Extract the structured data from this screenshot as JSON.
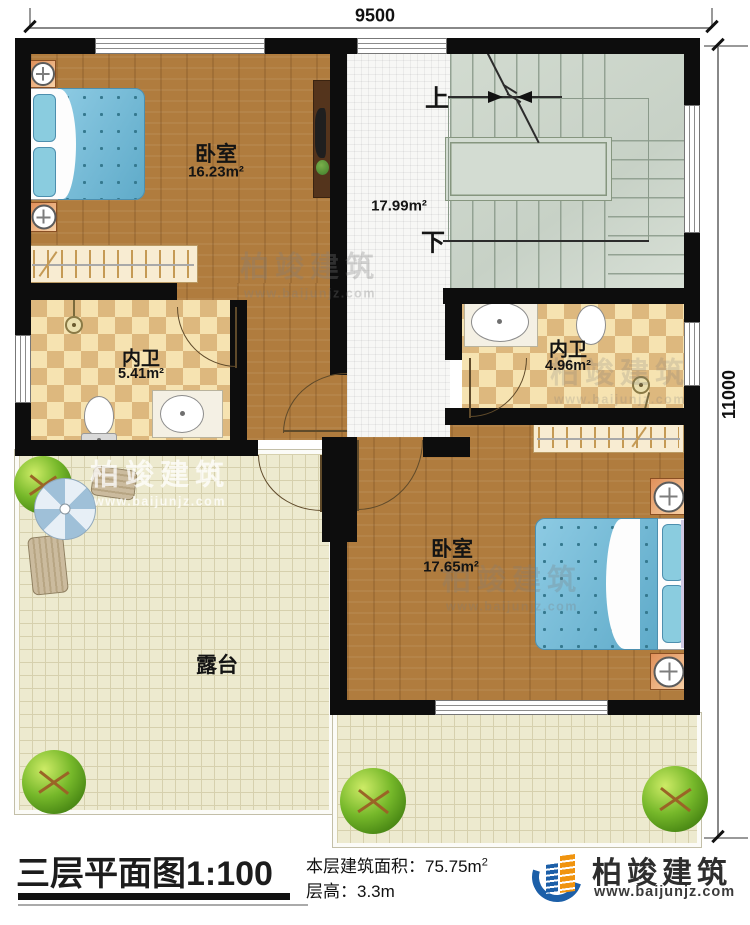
{
  "dimensions": {
    "top": "9500",
    "right": "11000"
  },
  "rooms": {
    "bedroom_top": {
      "name": "卧室",
      "area": "16.23m²"
    },
    "bedroom_bottom": {
      "name": "卧室",
      "area": "17.65m²"
    },
    "bathroom_left": {
      "name": "内卫",
      "area": "5.41m²"
    },
    "bathroom_right": {
      "name": "内卫",
      "area": "4.96m²"
    },
    "stair_hall": {
      "area": "17.99m²",
      "up_label": "上",
      "down_label": "下"
    },
    "terrace": {
      "name": "露台"
    }
  },
  "title_block": {
    "title": "三层平面图1:100",
    "floor_area_label": "本层建筑面积：",
    "floor_area_value": "75.75m",
    "floor_area_sup": "2",
    "floor_height_label": "层高：",
    "floor_height_value": "3.3m"
  },
  "brand": {
    "name": "柏竣建筑",
    "website": "www.baijunjz.com"
  },
  "watermark": {
    "name": "柏竣建筑",
    "website": "www.baijunjz.com"
  },
  "colors": {
    "wall": "#0d0d0d",
    "wood_floor": "#b07c3e",
    "tile_light": "#f6e3b1",
    "tile_dark": "#ddb87e",
    "stairs": "#ced7cc",
    "terrace": "#edeacf",
    "brand_blue": "#1c5fa8",
    "brand_orange": "#f0940f",
    "bed_blue": "#67b9da"
  }
}
